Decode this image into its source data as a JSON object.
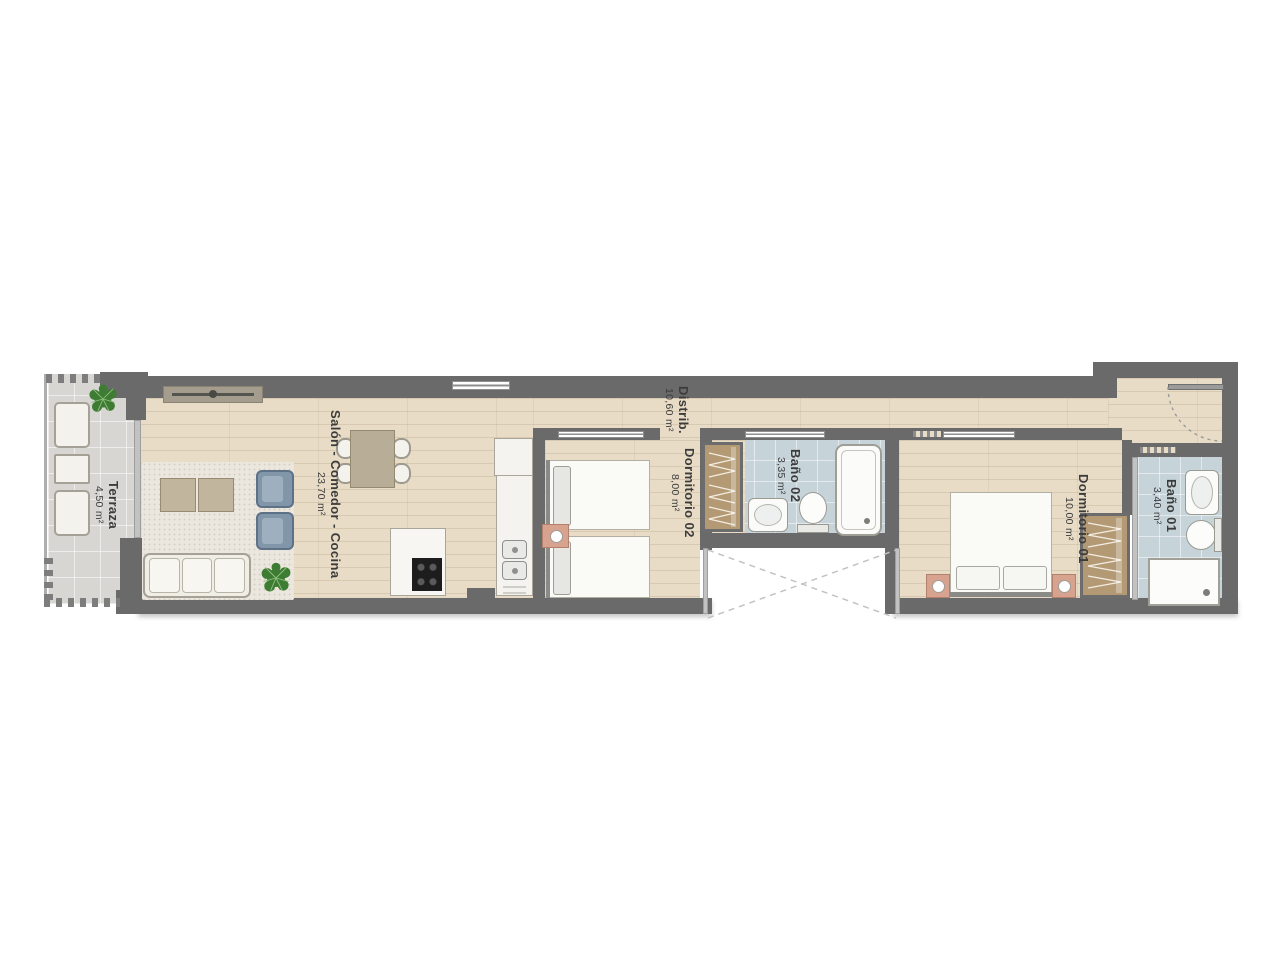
{
  "plan_title": "Apartment floor plan",
  "rooms": {
    "terraza": {
      "name": "Terraza",
      "area": "4,50 m²"
    },
    "salon": {
      "name": "Salón - Comedor - Cocina",
      "area": "23,70 m²"
    },
    "distrib": {
      "name": "Distrib.",
      "area": "10,60 m²"
    },
    "dormitorio02": {
      "name": "Dormitorio 02",
      "area": "8,00 m²"
    },
    "bano02": {
      "name": "Baño 02",
      "area": "3,35 m²"
    },
    "dormitorio01": {
      "name": "Dormitorio 01",
      "area": "10,00 m²"
    },
    "bano01": {
      "name": "Baño 01",
      "area": "3,40 m²"
    }
  },
  "palette": {
    "wall": "#6a6a6a",
    "wood_floor": "#e8dcc6",
    "terrace_floor": "#d7d6d2",
    "bath_floor": "#c6d3d9",
    "wardrobe": "#b39a74",
    "nightstand": "#d7a28e",
    "armchair": "#8196a9",
    "label_text": "#3c3c3c"
  }
}
